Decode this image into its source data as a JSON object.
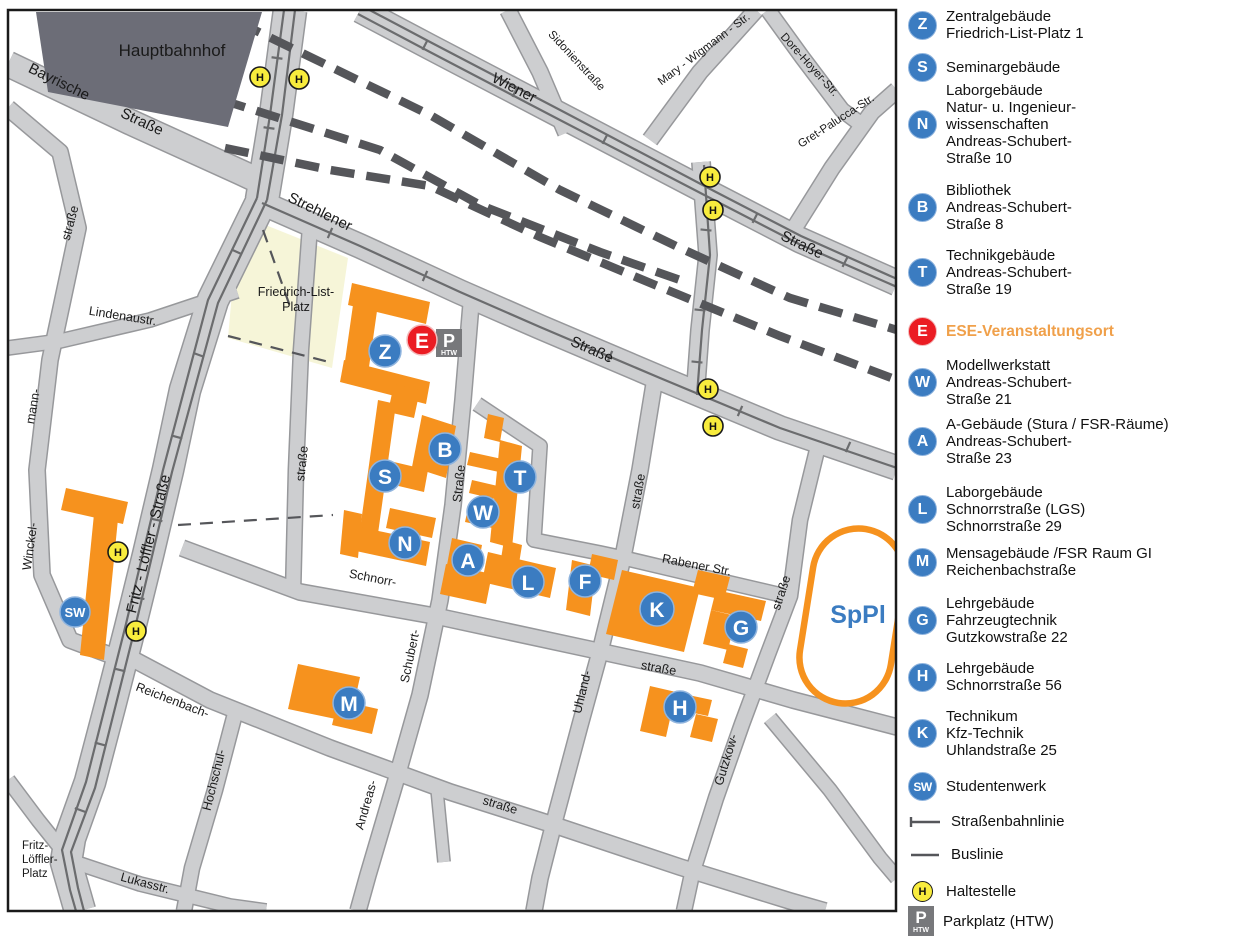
{
  "map": {
    "hauptbahnhof": "Hauptbahnhof",
    "streets": {
      "bayrische_1": "Bayrische",
      "bayrische_2": "Straße",
      "wiener_1": "Wiener",
      "wiener_2": "Straße",
      "sidonien": "Sidonienstraße",
      "mary_wigmann": "Mary - Wigmann - Str.",
      "dore_hoyer": "Dore-Hoyer-Str.",
      "gret_palucca": "Gret-Palucca-Str.",
      "strehlener_1": "Strehlener",
      "strehlener_2": "Straße",
      "fritz_loeffler": "Fritz - Löffler - Straße",
      "winckel": "Winckel-",
      "mann": "mann-",
      "winckel_strasse": "straße",
      "lindenau": "Lindenaustr.",
      "west_strasse": "straße",
      "andreas_schubert_strasse": "Straße",
      "schubert": "Schubert-",
      "andreas": "Andreas-",
      "schnorr_1": "Schnorr-",
      "schnorr_2": "straße",
      "uhland_strasse": "straße",
      "uhland": "Uhland-",
      "rabener": "Rabener Str.",
      "gutzkow_strasse": "straße",
      "gutzkow": "Gutzkow-",
      "reichenbach_1": "Reichenbach-",
      "reichenbach_2": "straße",
      "hochschul": "Hochschul-",
      "lukas": "Lukasstr.",
      "sppl": "SpPl"
    },
    "places": {
      "friedrich_list_1": "Friedrich-List-",
      "friedrich_list_2": "Platz",
      "fl_platz_1": "Fritz-",
      "fl_platz_2": "Löffler-",
      "fl_platz_3": "Platz"
    },
    "markers": {
      "z": "Z",
      "s": "S",
      "n": "N",
      "b": "B",
      "t": "T",
      "w": "W",
      "a": "A",
      "l": "L",
      "f": "F",
      "k": "K",
      "g": "G",
      "m": "M",
      "h": "H",
      "sw": "SW",
      "e": "E"
    },
    "parking": {
      "letter": "P",
      "sub": "HTW"
    },
    "stop": "H",
    "colors": {
      "building_orange": "#F6921E",
      "marker_blue": "#3B7CC1",
      "event_red": "#EB1C23",
      "stop_yellow": "#F8EC3D",
      "street_fill": "#CDCED0",
      "street_edge": "#97989B",
      "rail_dark": "#55565A",
      "tram_line": "#6B6C6E",
      "hbf_gray": "#6C6D77",
      "platz_cream": "#F6F5D8",
      "parking_gray": "#77787B",
      "ese_text": "#F0A04A",
      "sppl_blue": "#3B7CC1"
    }
  },
  "legend": {
    "items": [
      {
        "icon": "Z",
        "type": "building",
        "lines": [
          "Zentralgebäude",
          "Friedrich-List-Platz 1"
        ]
      },
      {
        "icon": "S",
        "type": "building",
        "lines": [
          "Seminargebäude"
        ]
      },
      {
        "icon": "N",
        "type": "building",
        "lines": [
          "Laborgebäude",
          "Natur- u. Ingenieur-",
          "wissenschaften",
          "Andreas-Schubert-",
          "Straße 10"
        ]
      },
      {
        "icon": "B",
        "type": "building",
        "lines": [
          "Bibliothek",
          "Andreas-Schubert-",
          "Straße 8"
        ]
      },
      {
        "icon": "T",
        "type": "building",
        "lines": [
          "Technikgebäude",
          "Andreas-Schubert-",
          "Straße 19"
        ]
      },
      {
        "icon": "E",
        "type": "event",
        "lines": [
          "ESE-Veranstaltungsort"
        ]
      },
      {
        "icon": "W",
        "type": "building",
        "lines": [
          "Modellwerkstatt",
          "Andreas-Schubert-",
          "Straße 21"
        ]
      },
      {
        "icon": "A",
        "type": "building",
        "lines": [
          "A-Gebäude (Stura / FSR-Räume)",
          "Andreas-Schubert-",
          "Straße 23"
        ]
      },
      {
        "icon": "L",
        "type": "building",
        "lines": [
          "Laborgebäude",
          "Schnorrstraße (LGS)",
          "Schnorrstraße 29"
        ]
      },
      {
        "icon": "M",
        "type": "building",
        "lines": [
          "Mensagebäude /FSR Raum GI",
          "Reichenbachstraße"
        ]
      },
      {
        "icon": "G",
        "type": "building",
        "lines": [
          "Lehrgebäude",
          "Fahrzeugtechnik",
          "Gutzkowstraße 22"
        ]
      },
      {
        "icon": "H",
        "type": "building",
        "lines": [
          "Lehrgebäude",
          "Schnorrstraße 56"
        ]
      },
      {
        "icon": "K",
        "type": "building",
        "lines": [
          "Technikum",
          "Kfz-Technik",
          "Uhlandstraße 25"
        ]
      },
      {
        "icon": "SW",
        "type": "building",
        "lines": [
          "Studentenwerk"
        ]
      },
      {
        "icon": "tram",
        "type": "symbol",
        "lines": [
          "Straßenbahnlinie"
        ]
      },
      {
        "icon": "bus",
        "type": "symbol",
        "lines": [
          "Buslinie"
        ]
      },
      {
        "icon": "H",
        "type": "stop",
        "lines": [
          "Haltestelle"
        ]
      },
      {
        "icon": "P",
        "type": "parking",
        "sub": "HTW",
        "lines": [
          "Parkplatz (HTW)"
        ]
      }
    ]
  }
}
